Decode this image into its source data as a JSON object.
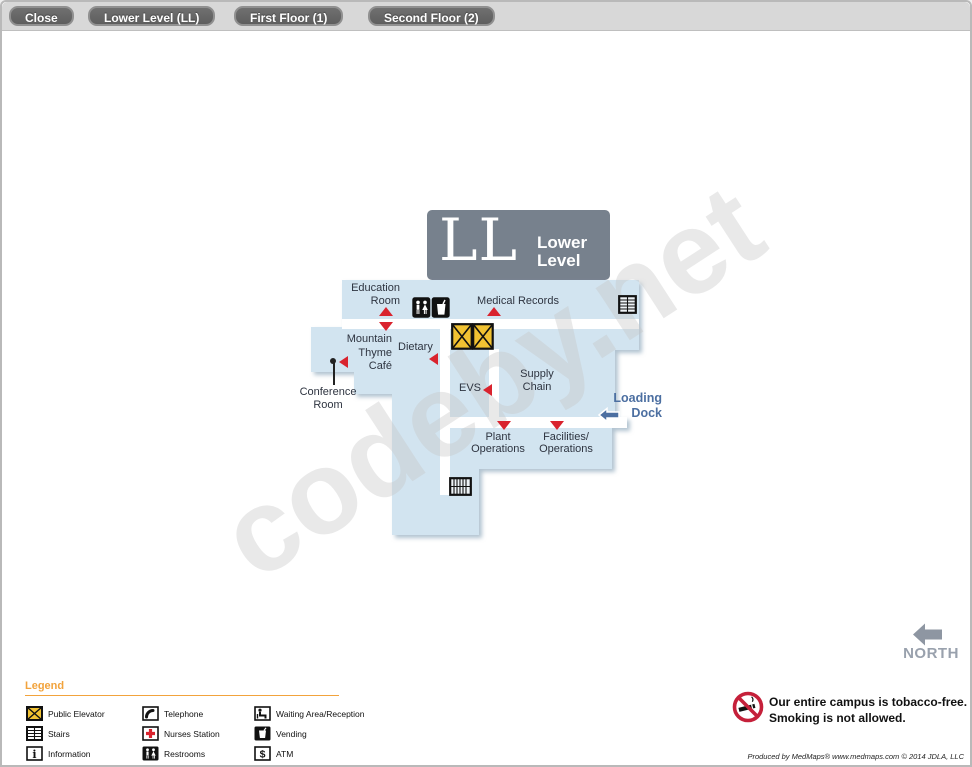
{
  "toolbar": {
    "buttons": [
      {
        "label": "Close"
      },
      {
        "label": "Lower Level (LL)"
      },
      {
        "label": "First Floor (1)"
      },
      {
        "label": "Second Floor (2)"
      }
    ]
  },
  "map": {
    "title_abbr": "LL",
    "title_line1": "Lower",
    "title_line2": "Level",
    "labels": {
      "education_room": "Education\nRoom",
      "medical_records": "Medical Records",
      "mountain_thyme_cafe": "Mountain\nThyme\nCafé",
      "dietary": "Dietary",
      "conference_room": "Conference\nRoom",
      "evs": "EVS",
      "supply_chain": "Supply\nChain",
      "loading_dock": "Loading\nDock",
      "plant_operations": "Plant\nOperations",
      "facilities_operations": "Facilities/\nOperations"
    }
  },
  "legend": {
    "title": "Legend",
    "items": [
      {
        "icon": "public-elevator-icon",
        "label": "Public Elevator"
      },
      {
        "icon": "stairs-icon",
        "label": "Stairs"
      },
      {
        "icon": "information-icon",
        "label": "Information"
      },
      {
        "icon": "telephone-icon",
        "label": "Telephone"
      },
      {
        "icon": "nurses-station-icon",
        "label": "Nurses Station"
      },
      {
        "icon": "restrooms-icon",
        "label": "Restrooms"
      },
      {
        "icon": "waiting-area-icon",
        "label": "Waiting Area/Reception"
      },
      {
        "icon": "vending-icon",
        "label": "Vending"
      },
      {
        "icon": "atm-icon",
        "label": "ATM"
      }
    ]
  },
  "compass": {
    "label": "NORTH"
  },
  "notice": {
    "text": "Our entire campus is tobacco-free.\nSmoking is not allowed."
  },
  "footer": {
    "credit": "Produced by MedMaps® www.medmaps.com © 2014 JDLA, LLC"
  },
  "watermark": {
    "text": "codeby.net"
  },
  "colors": {
    "marker_red": "#d9232e",
    "map_fill": "#d2e4f0",
    "title_gray": "#77818d",
    "loading_dock_blue": "#4c6fa1",
    "legend_orange": "#f2a33c",
    "elevator_yellow": "#f1c232",
    "toolbar_button_gray": "#656565",
    "compass_gray": "#99a1ad"
  }
}
